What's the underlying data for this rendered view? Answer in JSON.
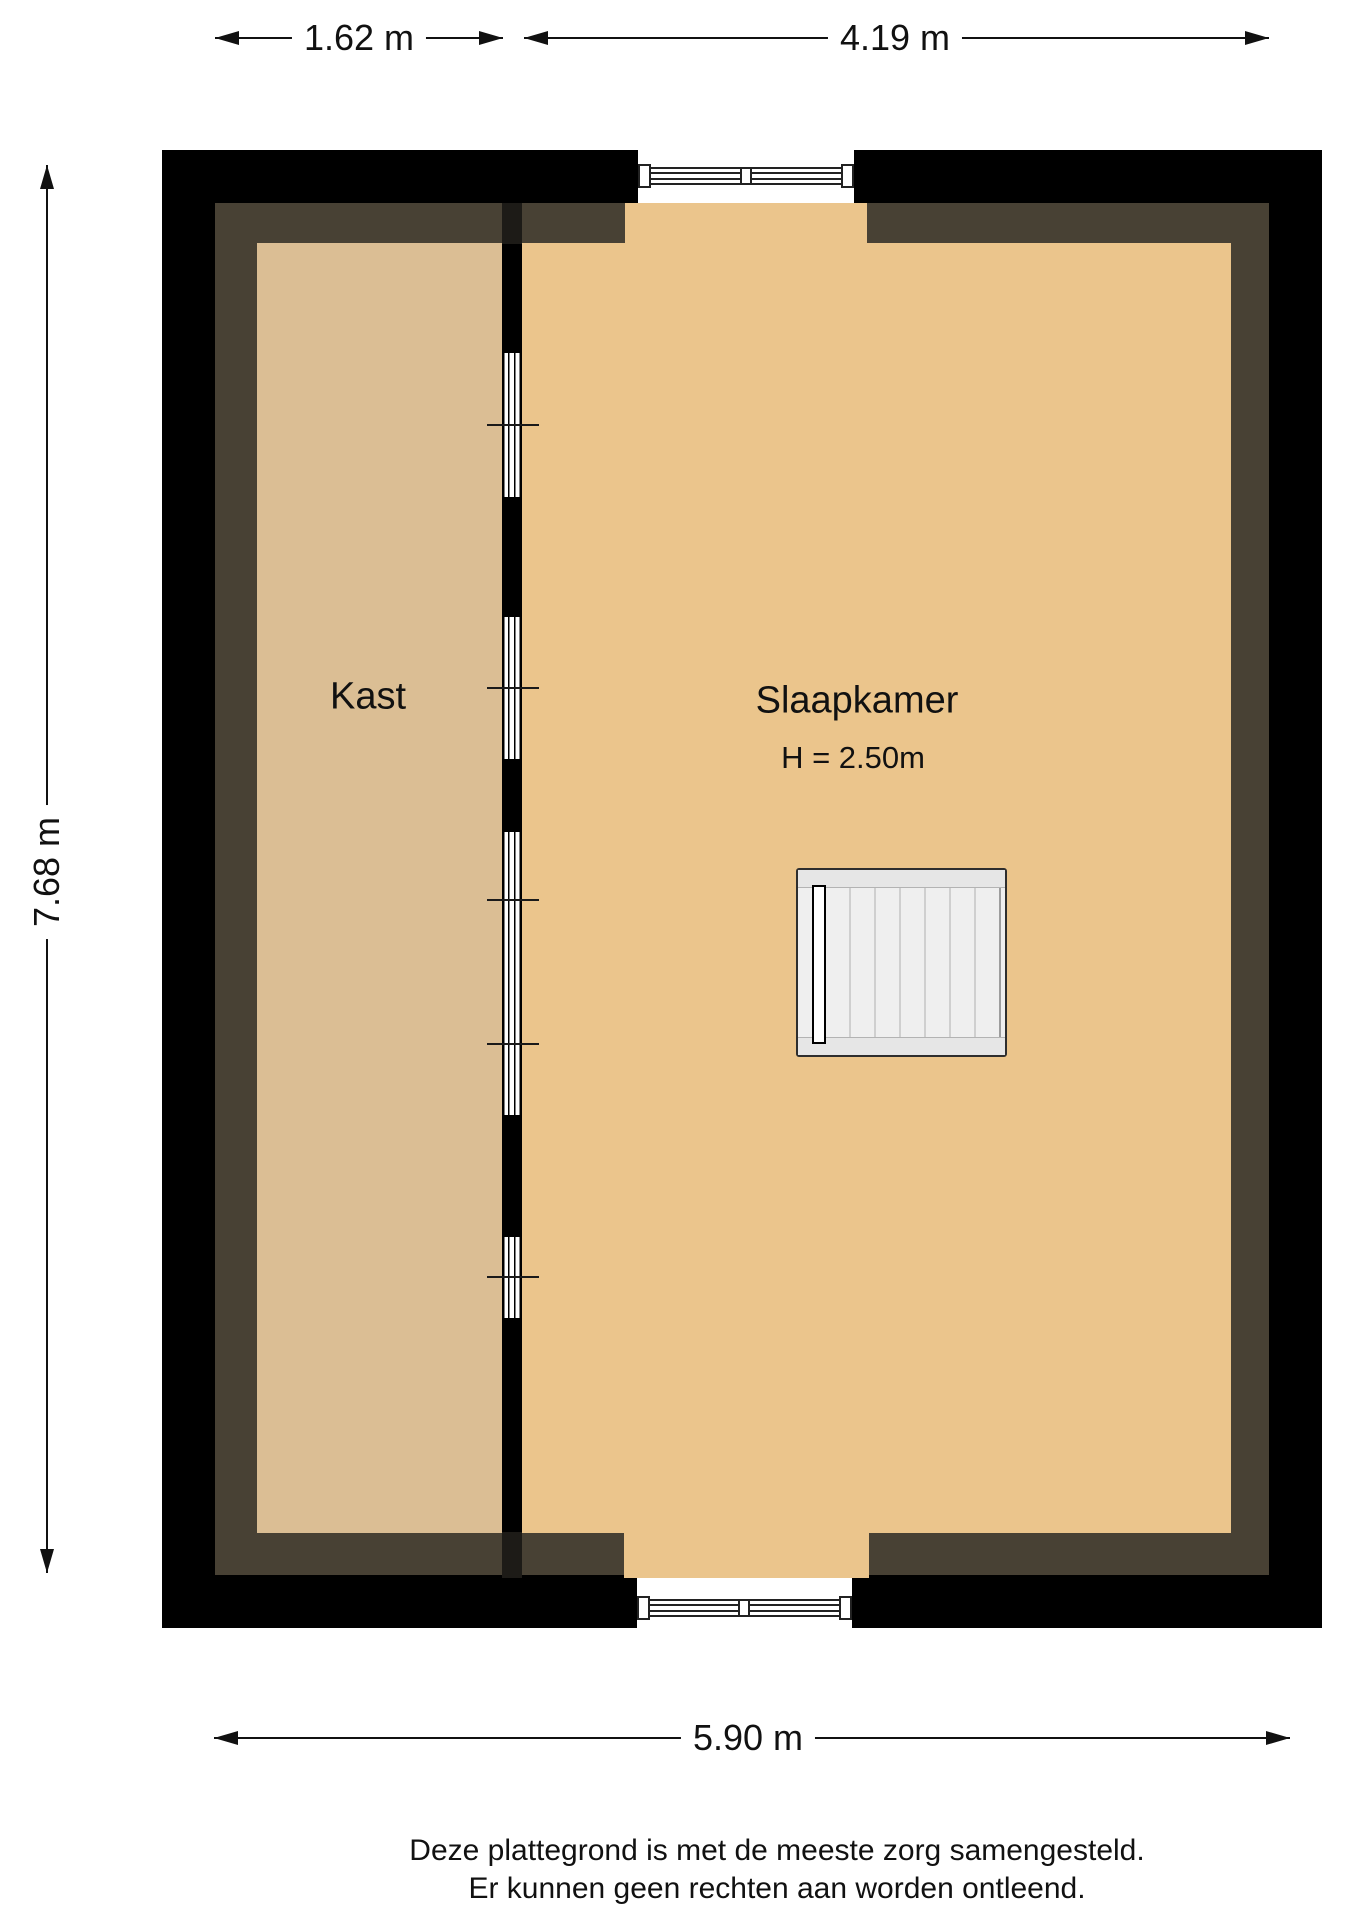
{
  "plan": {
    "rooms": {
      "kast": {
        "name": "Kast"
      },
      "slaapkamer": {
        "name": "Slaapkamer",
        "ceiling_height": "H = 2.50m"
      }
    },
    "features": [
      "staircase",
      "top-window",
      "bottom-window",
      "closet-partition-with-glass"
    ]
  },
  "dimensions": {
    "top_left": {
      "label": "1.62 m"
    },
    "top_right": {
      "label": "4.19 m"
    },
    "left": {
      "label": "7.68 m"
    },
    "bottom": {
      "label": "5.90 m"
    }
  },
  "disclaimer": {
    "line1": "Deze plattegrond is met de meeste zorg samengesteld.",
    "line2": "Er kunnen geen rechten aan worden ontleend."
  },
  "colors": {
    "wall": "#000000",
    "wall_shadow": "#484134",
    "kast_floor": "#dbbe94",
    "slaapkamer_floor": "#ebc58c",
    "stair_tread": "#efefef",
    "stair_band": "#e6e6e6",
    "line": "#111111",
    "background": "#ffffff"
  }
}
